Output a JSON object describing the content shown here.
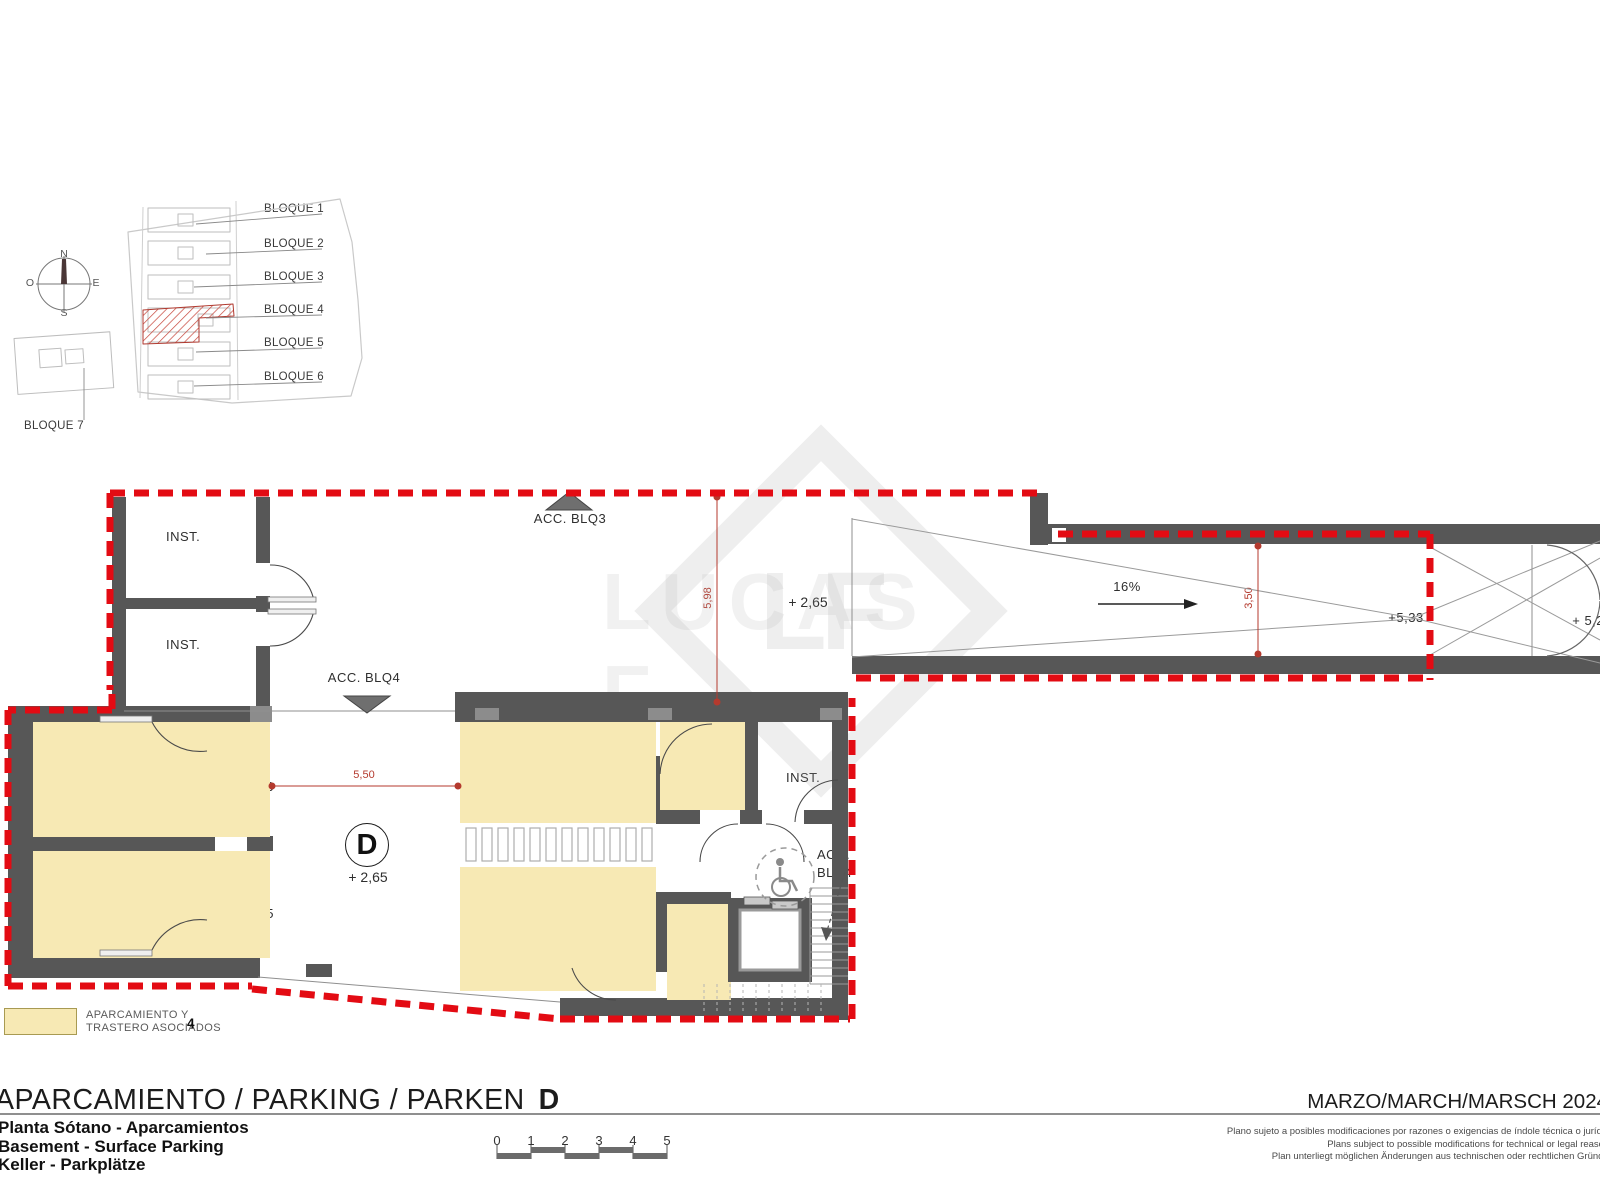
{
  "site_plan": {
    "compass": {
      "n": "N",
      "o": "O",
      "e": "E",
      "s": "S"
    },
    "blocks": [
      {
        "label": "BLOQUE 1"
      },
      {
        "label": "BLOQUE 2"
      },
      {
        "label": "BLOQUE 3"
      },
      {
        "label": "BLOQUE 4"
      },
      {
        "label": "BLOQUE 5"
      },
      {
        "label": "BLOQUE 6"
      },
      {
        "label": "BLOQUE 7"
      }
    ]
  },
  "plan": {
    "upper": {
      "inst1": "INST.",
      "inst2": "INST.",
      "acc_blq3": "ACC. BLQ3",
      "acc_blq4": "ACC. BLQ4",
      "dim_598": "5,98",
      "level_265": "+ 2,65"
    },
    "ramp": {
      "slope": "16%",
      "dim_350": "3,50",
      "level_533": "+5,33",
      "level_529": "+ 5,29"
    },
    "lower": {
      "tp16": "TP_16",
      "tp15": "TP_15",
      "apt16": "APT_16",
      "apt15": "APT_15",
      "apt13": "APT_13",
      "apt14": "APT_14",
      "tp13": "TP_13",
      "tp14": "TP_14",
      "inst": "INST.",
      "zone_letter": "D",
      "level_265": "+ 2,65",
      "dim_550": "5,50",
      "acc_line1": "ACC.",
      "acc_line2": "BLQ4"
    },
    "icons": {
      "accessible_parking": "wheelchair-icon"
    }
  },
  "legend": {
    "line1": "APARCAMIENTO Y",
    "line2": "TRASTERO ASOCIADOS",
    "count": "4"
  },
  "title_block": {
    "main": "APARCAMIENTO / PARKING / PARKEN",
    "letter": "D",
    "date": "MARZO/MARCH/MARSCH 2024",
    "sub_es": "Planta Sótano - Aparcamientos",
    "sub_en": "Basement - Surface Parking",
    "sub_de": "Keller - Parkplätze",
    "scale": {
      "labels": [
        "0",
        "1",
        "2",
        "3",
        "4",
        "5"
      ]
    },
    "disclaimer": [
      "Plano sujeto a posibles modificaciones por razones o exigencias de índole técnica o jurídica",
      "Plans subject to possible modifications for technical or legal reasons",
      "Plan unterliegt möglichen Änderungen aus technischen oder rechtlichen Gründen"
    ]
  },
  "watermark": {
    "logo": "LF",
    "name": "LUCAS F"
  },
  "colors": {
    "boundary_red": "#e30b13",
    "dimension_red": "#b43a2e",
    "parking_yellow": "#f7e9b4",
    "wall_gray": "#575757"
  }
}
